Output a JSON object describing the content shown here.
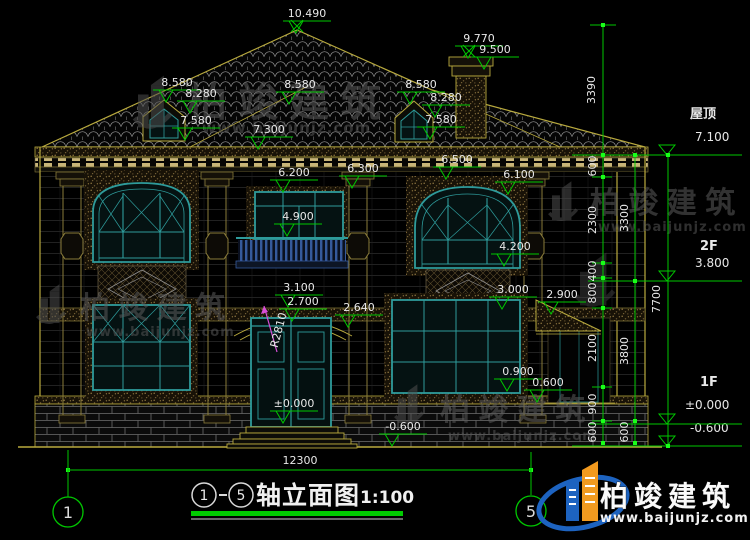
{
  "colors": {
    "background": "#000000",
    "dim_green": "#00c800",
    "grip_green": "#19ff19",
    "outline_yellow": "#b9aa3e",
    "frame_teal": "#2e9b9b",
    "radius_magenta": "#d94fd9",
    "underline_green": "#00cc00",
    "logo_blue": "#1d63c0",
    "logo_orange": "#f29a1f"
  },
  "annotations": {
    "elevations": [
      {
        "t": "10.490",
        "x": 307,
        "y": 17
      },
      {
        "t": "9.770",
        "x": 479,
        "y": 42
      },
      {
        "t": "9.500",
        "x": 495,
        "y": 53
      },
      {
        "t": "8.580",
        "x": 177,
        "y": 86
      },
      {
        "t": "8.280",
        "x": 201,
        "y": 97
      },
      {
        "t": "7.580",
        "x": 196,
        "y": 124
      },
      {
        "t": "8.580",
        "x": 300,
        "y": 88
      },
      {
        "t": "8.580",
        "x": 421,
        "y": 88
      },
      {
        "t": "8.280",
        "x": 446,
        "y": 101
      },
      {
        "t": "7.580",
        "x": 441,
        "y": 123
      },
      {
        "t": "7.300",
        "x": 269,
        "y": 133
      },
      {
        "t": "6.200",
        "x": 294,
        "y": 176
      },
      {
        "t": "6.300",
        "x": 363,
        "y": 172
      },
      {
        "t": "6.500",
        "x": 457,
        "y": 163
      },
      {
        "t": "6.100",
        "x": 519,
        "y": 178
      },
      {
        "t": "4.900",
        "x": 298,
        "y": 220
      },
      {
        "t": "4.200",
        "x": 515,
        "y": 250
      },
      {
        "t": "3.100",
        "x": 299,
        "y": 291
      },
      {
        "t": "2.700",
        "x": 303,
        "y": 305
      },
      {
        "t": "2.640",
        "x": 359,
        "y": 311
      },
      {
        "t": "3.000",
        "x": 513,
        "y": 293
      },
      {
        "t": "2.900",
        "x": 562,
        "y": 298
      },
      {
        "t": "0.900",
        "x": 518,
        "y": 375
      },
      {
        "t": "0.600",
        "x": 548,
        "y": 386
      },
      {
        "t": "±0.000",
        "x": 294,
        "y": 407
      },
      {
        "t": "-0.600",
        "x": 403,
        "y": 430
      }
    ],
    "levels": [
      {
        "label": "屋顶",
        "lx": 690,
        "ly": 118,
        "val": "7.100",
        "vx": 695,
        "vy": 141,
        "tx": 667,
        "ty": 155
      },
      {
        "label": "2F",
        "lx": 700,
        "ly": 250,
        "val": "3.800",
        "vx": 695,
        "vy": 267,
        "tx": 667,
        "ty": 281
      },
      {
        "label": "1F",
        "lx": 700,
        "ly": 386,
        "val": "±0.000",
        "vx": 685,
        "vy": 409,
        "tx": 667,
        "ty": 424
      },
      {
        "label": "",
        "lx": 0,
        "ly": 0,
        "val": "-0.600",
        "vx": 690,
        "vy": 432,
        "tx": 667,
        "ty": 446
      }
    ],
    "vdims": [
      {
        "t": "3390",
        "x": 595,
        "y": 90
      },
      {
        "t": "600",
        "x": 596,
        "y": 166
      },
      {
        "t": "2300",
        "x": 596,
        "y": 220
      },
      {
        "t": "400",
        "x": 596,
        "y": 271
      },
      {
        "t": "800",
        "x": 596,
        "y": 293
      },
      {
        "t": "2100",
        "x": 596,
        "y": 348
      },
      {
        "t": "900",
        "x": 596,
        "y": 404
      },
      {
        "t": "600",
        "x": 596,
        "y": 432
      },
      {
        "t": "3300",
        "x": 628,
        "y": 218
      },
      {
        "t": "3800",
        "x": 628,
        "y": 351
      },
      {
        "t": "600",
        "x": 628,
        "y": 432
      },
      {
        "t": "7700",
        "x": 660,
        "y": 299
      }
    ],
    "hdim": {
      "t": "12300",
      "x": 300,
      "y": 464
    },
    "radius": {
      "t": "R2810",
      "x": 282,
      "y": 331
    }
  },
  "axes": {
    "left": "1",
    "right": "5"
  },
  "title": {
    "from": "1",
    "to": "5",
    "text": "轴立面图",
    "scale": "1:100"
  },
  "logo": {
    "name": "柏竣建筑",
    "url": "www.baijunjz.com"
  },
  "watermark": {
    "name": "柏竣建筑",
    "url": "www.baijunjz.com"
  }
}
